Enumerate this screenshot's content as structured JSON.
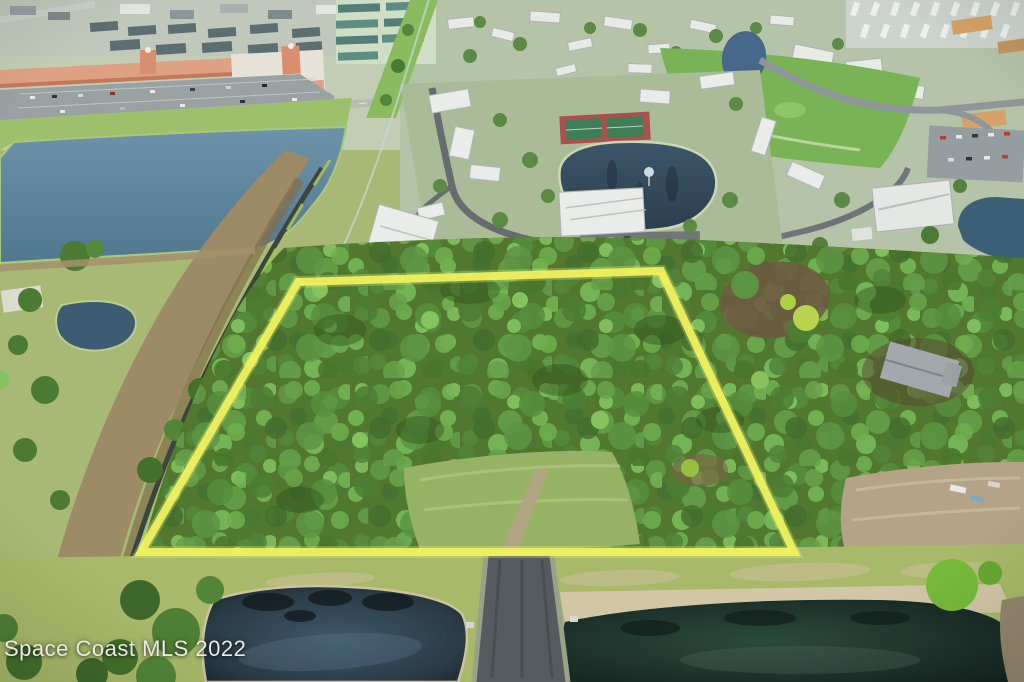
{
  "photo": {
    "description": "Aerial drone photo of a vacant wooded parcel outlined in yellow, surrounded by condo communities, a shopping plaza, lakes and retention ponds",
    "watermark": "Space Coast MLS 2022",
    "boundary": {
      "shape": "quadrilateral",
      "points": "298,282 661,271 794,552 141,552",
      "color": "#f1f25e"
    },
    "palette": {
      "canopy_green": "#52782f",
      "field_green": "#a8b96a",
      "lake_blue": "#5e86a0",
      "dark_pond": "#17241f",
      "asphalt_gray": "#565b5f",
      "plaza_salmon": "#dfa184",
      "tennis_red": "#ad4f4c",
      "tennis_green": "#3e7f58",
      "sand_tan": "#cfc2a0"
    }
  }
}
